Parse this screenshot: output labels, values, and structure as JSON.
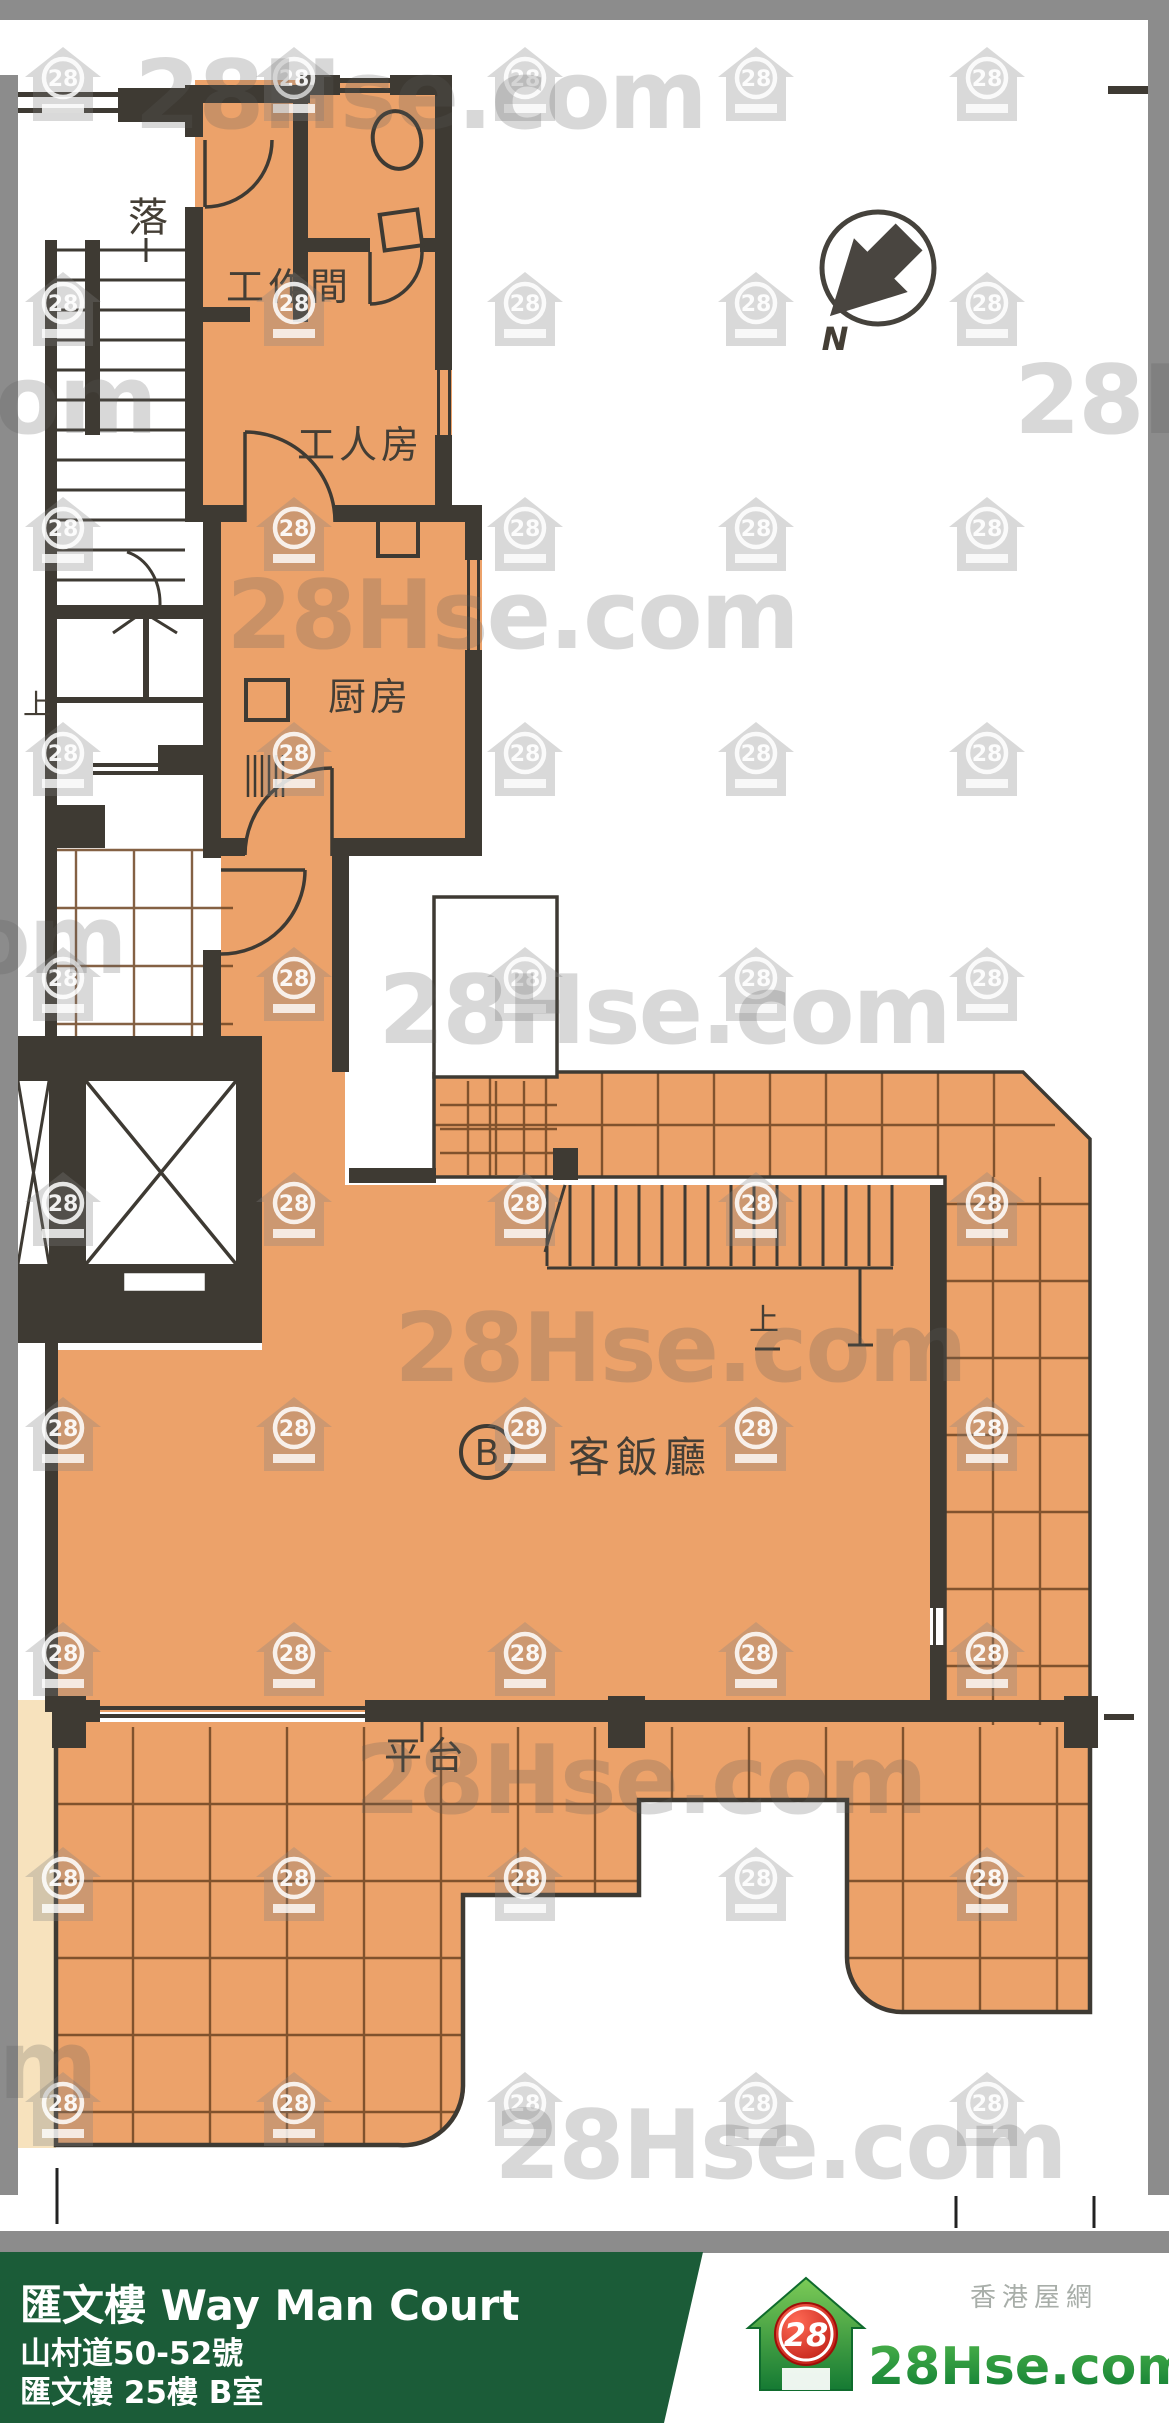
{
  "watermark": {
    "brand_text": "28Hse.com",
    "house_number": "28"
  },
  "floor_plan": {
    "compass_label": "N",
    "unit_label": "B",
    "rooms": {
      "workroom": {
        "label": "工作間"
      },
      "maid_room": {
        "label": "工人房"
      },
      "kitchen": {
        "label": "厨房"
      },
      "living_dining": {
        "label": "客飯廳"
      },
      "terrace": {
        "label": "平台"
      }
    },
    "stairs": {
      "down": {
        "label": "落"
      },
      "up_common": {
        "label": "上"
      },
      "up_internal": {
        "label": "上"
      }
    }
  },
  "footer": {
    "building_name": "匯文樓 Way Man Court",
    "address": "山村道50-52號",
    "unit_info": "匯文樓 25樓 B室",
    "site_name_cn": "香港屋網",
    "brand": "28Hse.com",
    "brand_number": "28",
    "colors": {
      "footer_green": "#1B5C38",
      "logo_green": "#1E8A3C",
      "logo_red": "#D01F14",
      "plan_orange": "#ECA26A",
      "wall_dark": "#3E3A33",
      "frame_gray": "#8C8C8C"
    }
  }
}
